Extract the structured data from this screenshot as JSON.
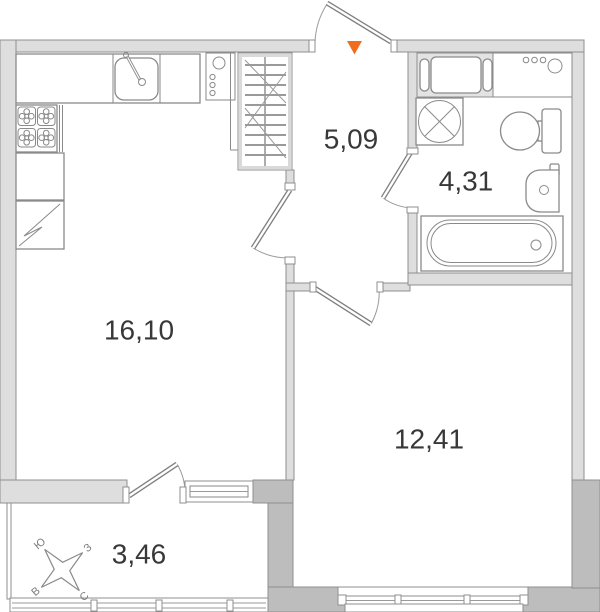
{
  "floor_plan": {
    "rooms": {
      "hallway": {
        "area": "5,09"
      },
      "bathroom": {
        "area": "4,31"
      },
      "kitchen_living": {
        "area": "16,10"
      },
      "room": {
        "area": "12,41"
      },
      "balcony": {
        "area": "3,46"
      }
    },
    "compass": {
      "south": "Ю",
      "west": "З",
      "north": "С",
      "east": "В"
    },
    "colors": {
      "wall_light": "#dedede",
      "wall_dark": "#bdbdbd",
      "wall_outline": "#8f8f8f",
      "fixture_line": "#8a8a8a",
      "entrance_marker": "#ee6e1e",
      "label_text": "#383838"
    },
    "icons": [
      "entrance-arrow-icon",
      "door-swing-icon",
      "window-icon",
      "wardrobe-icon",
      "kitchen-counter-icon",
      "kitchen-sink-icon",
      "stove-icon",
      "kitchen-cabinet-icon",
      "refrigerator-icon",
      "pipe-risers-icon",
      "washing-machine-icon",
      "bathroom-cabinet-icon",
      "toilet-icon",
      "bathroom-sink-icon",
      "bathtub-icon",
      "balcony-glazing-icon",
      "compass-rose-icon"
    ]
  }
}
